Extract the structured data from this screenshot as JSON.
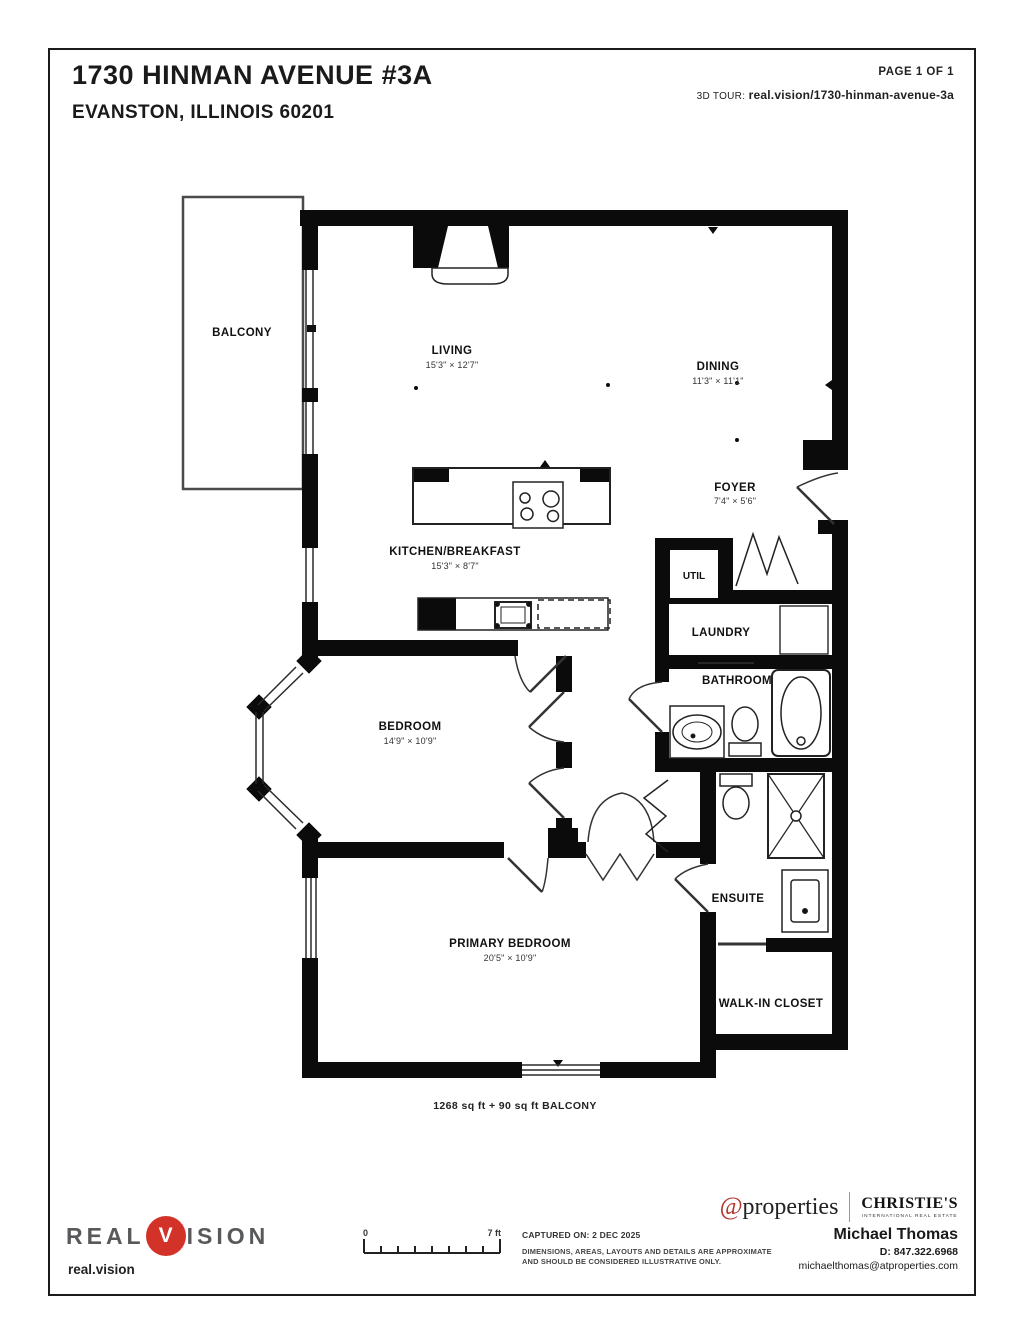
{
  "header": {
    "title": "1730 HINMAN AVENUE #3A",
    "subtitle": "EVANSTON, ILLINOIS 60201",
    "page_label": "PAGE 1 OF 1",
    "tour_label": "3D TOUR:",
    "tour_url": "real.vision/1730-hinman-avenue-3a"
  },
  "plan": {
    "rooms": {
      "balcony": {
        "name": "BALCONY"
      },
      "living": {
        "name": "LIVING",
        "dims": "15'3\" × 12'7\""
      },
      "dining": {
        "name": "DINING",
        "dims": "11'3\" × 11'1\""
      },
      "foyer": {
        "name": "FOYER",
        "dims": "7'4\" × 5'6\""
      },
      "kitchen": {
        "name": "KITCHEN/BREAKFAST",
        "dims": "15'3\" × 8'7\""
      },
      "util": {
        "name": "UTIL"
      },
      "laundry": {
        "name": "LAUNDRY"
      },
      "bathroom": {
        "name": "BATHROOM"
      },
      "bedroom": {
        "name": "BEDROOM",
        "dims": "14'9\" × 10'9\""
      },
      "ensuite": {
        "name": "ENSUITE"
      },
      "primary_bedroom": {
        "name": "PRIMARY BEDROOM",
        "dims": "20'5\" × 10'9\""
      },
      "walk_in_closet": {
        "name": "WALK-IN CLOSET"
      }
    },
    "area_note": "1268 sq ft + 90 sq ft BALCONY"
  },
  "footer": {
    "logo": {
      "word1": "REAL",
      "v": "V",
      "word2": "ISION",
      "site": "real.vision",
      "red": "#d23227"
    },
    "scale": {
      "zero": "0",
      "max": "7 ft"
    },
    "captured": "CAPTURED ON: 2 DEC 2025",
    "disclaimer1": "DIMENSIONS, AREAS, LAYOUTS AND DETAILS ARE APPROXIMATE",
    "disclaimer2": "AND SHOULD BE CONSIDERED ILLUSTRATIVE ONLY.",
    "brokerage": {
      "at": "@",
      "name": "properties",
      "christies": "CHRISTIE'S",
      "christies_sub": "INTERNATIONAL REAL ESTATE",
      "at_red": "#b5342c"
    },
    "agent": {
      "name": "Michael Thomas",
      "phone": "D: 847.322.6968",
      "email": "michaelthomas@atproperties.com"
    }
  }
}
